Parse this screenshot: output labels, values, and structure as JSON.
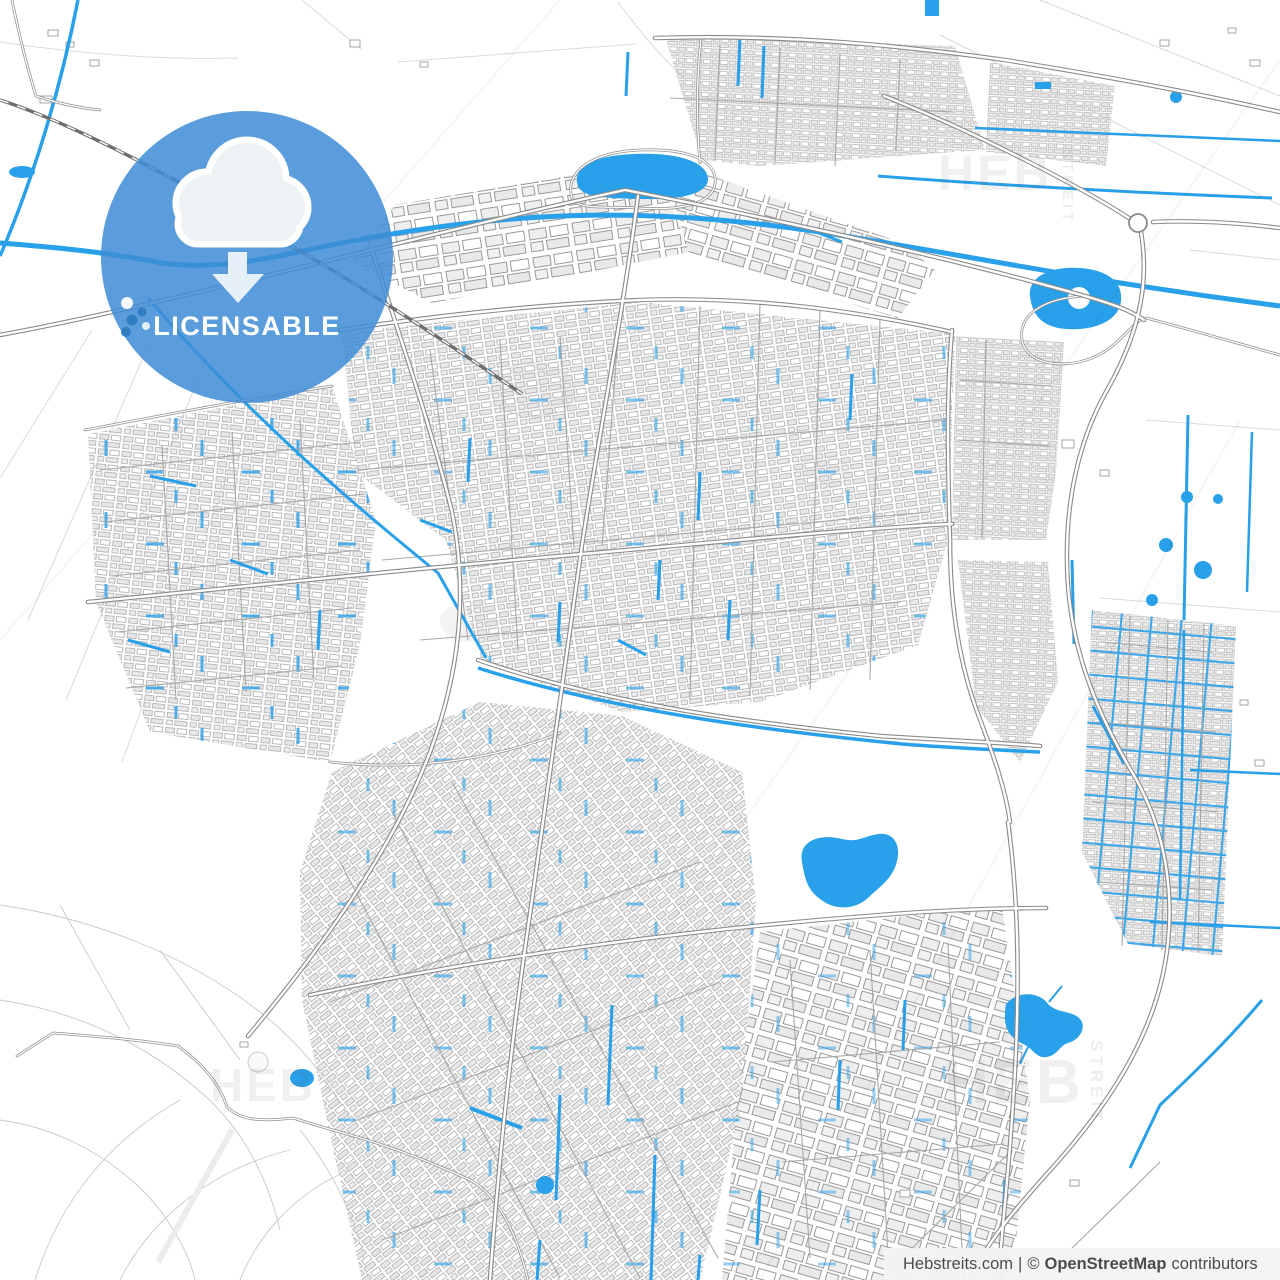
{
  "page": {
    "type": "vector-city-map-preview"
  },
  "badge": {
    "label": "LICENSABLE",
    "icon": "cloud-download-icon",
    "circle_color": "#3E8CD6",
    "text_color": "#FFFFFF"
  },
  "watermarks": [
    {
      "text": "HEB",
      "position": "top-right"
    },
    {
      "text": "STREIT",
      "position": "top-right-vertical"
    },
    {
      "text": "HEB",
      "position": "bottom-left"
    },
    {
      "text": "HEB",
      "position": "bottom-right"
    },
    {
      "text": "STREIT",
      "position": "bottom-right-vertical"
    }
  ],
  "attribution": {
    "source": "Hebstreits.com",
    "separator": "|",
    "copyright": "©",
    "owner": "OpenStreetMap",
    "suffix": "contributors",
    "full_text": "Hebstreits.com | © OpenStreetMap contributors"
  },
  "map_colors": {
    "background": "#FFFFFF",
    "water_blue": "#29A0EA",
    "road_casing_gray": "#8A8A8A",
    "building_fill_gray": "#E7E7E7",
    "building_stroke_gray": "#A3A3A3",
    "parcel_line_gray": "#DADADA"
  }
}
